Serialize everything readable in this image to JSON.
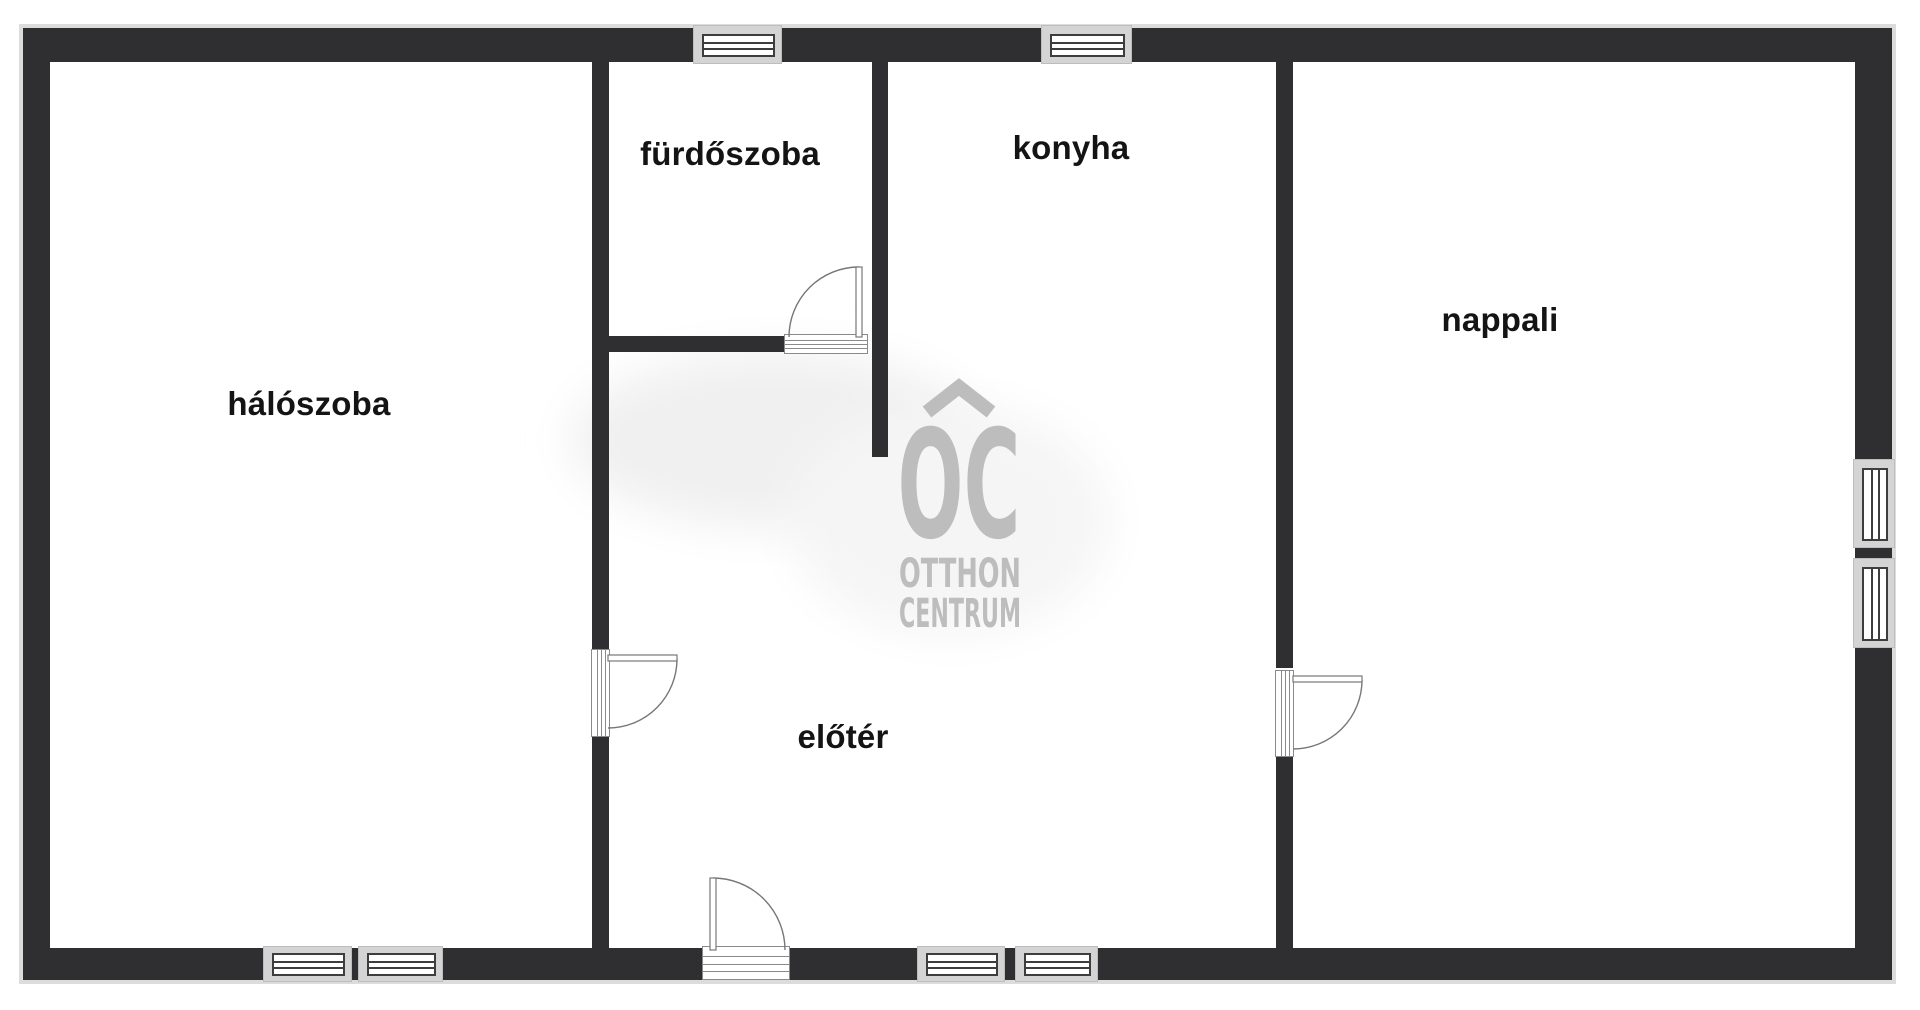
{
  "plan": {
    "rooms": [
      {
        "id": "haloszoba",
        "label": "hálószoba"
      },
      {
        "id": "furdoszoba",
        "label": "fürdőszoba"
      },
      {
        "id": "konyha",
        "label": "konyha"
      },
      {
        "id": "nappali",
        "label": "nappali"
      },
      {
        "id": "eloter",
        "label": "előtér"
      }
    ],
    "watermark": {
      "monogram": "OC",
      "line1": "OTTHON",
      "line2": "CENTRUM"
    },
    "colors": {
      "wall": "#2f2f31",
      "window_frame": "#d4d4d4",
      "pane_border": "#3d3d3d",
      "door_line": "#777777",
      "watermark_gray": "#bdbdbd",
      "label_text": "#141414",
      "background": "#ffffff"
    }
  }
}
